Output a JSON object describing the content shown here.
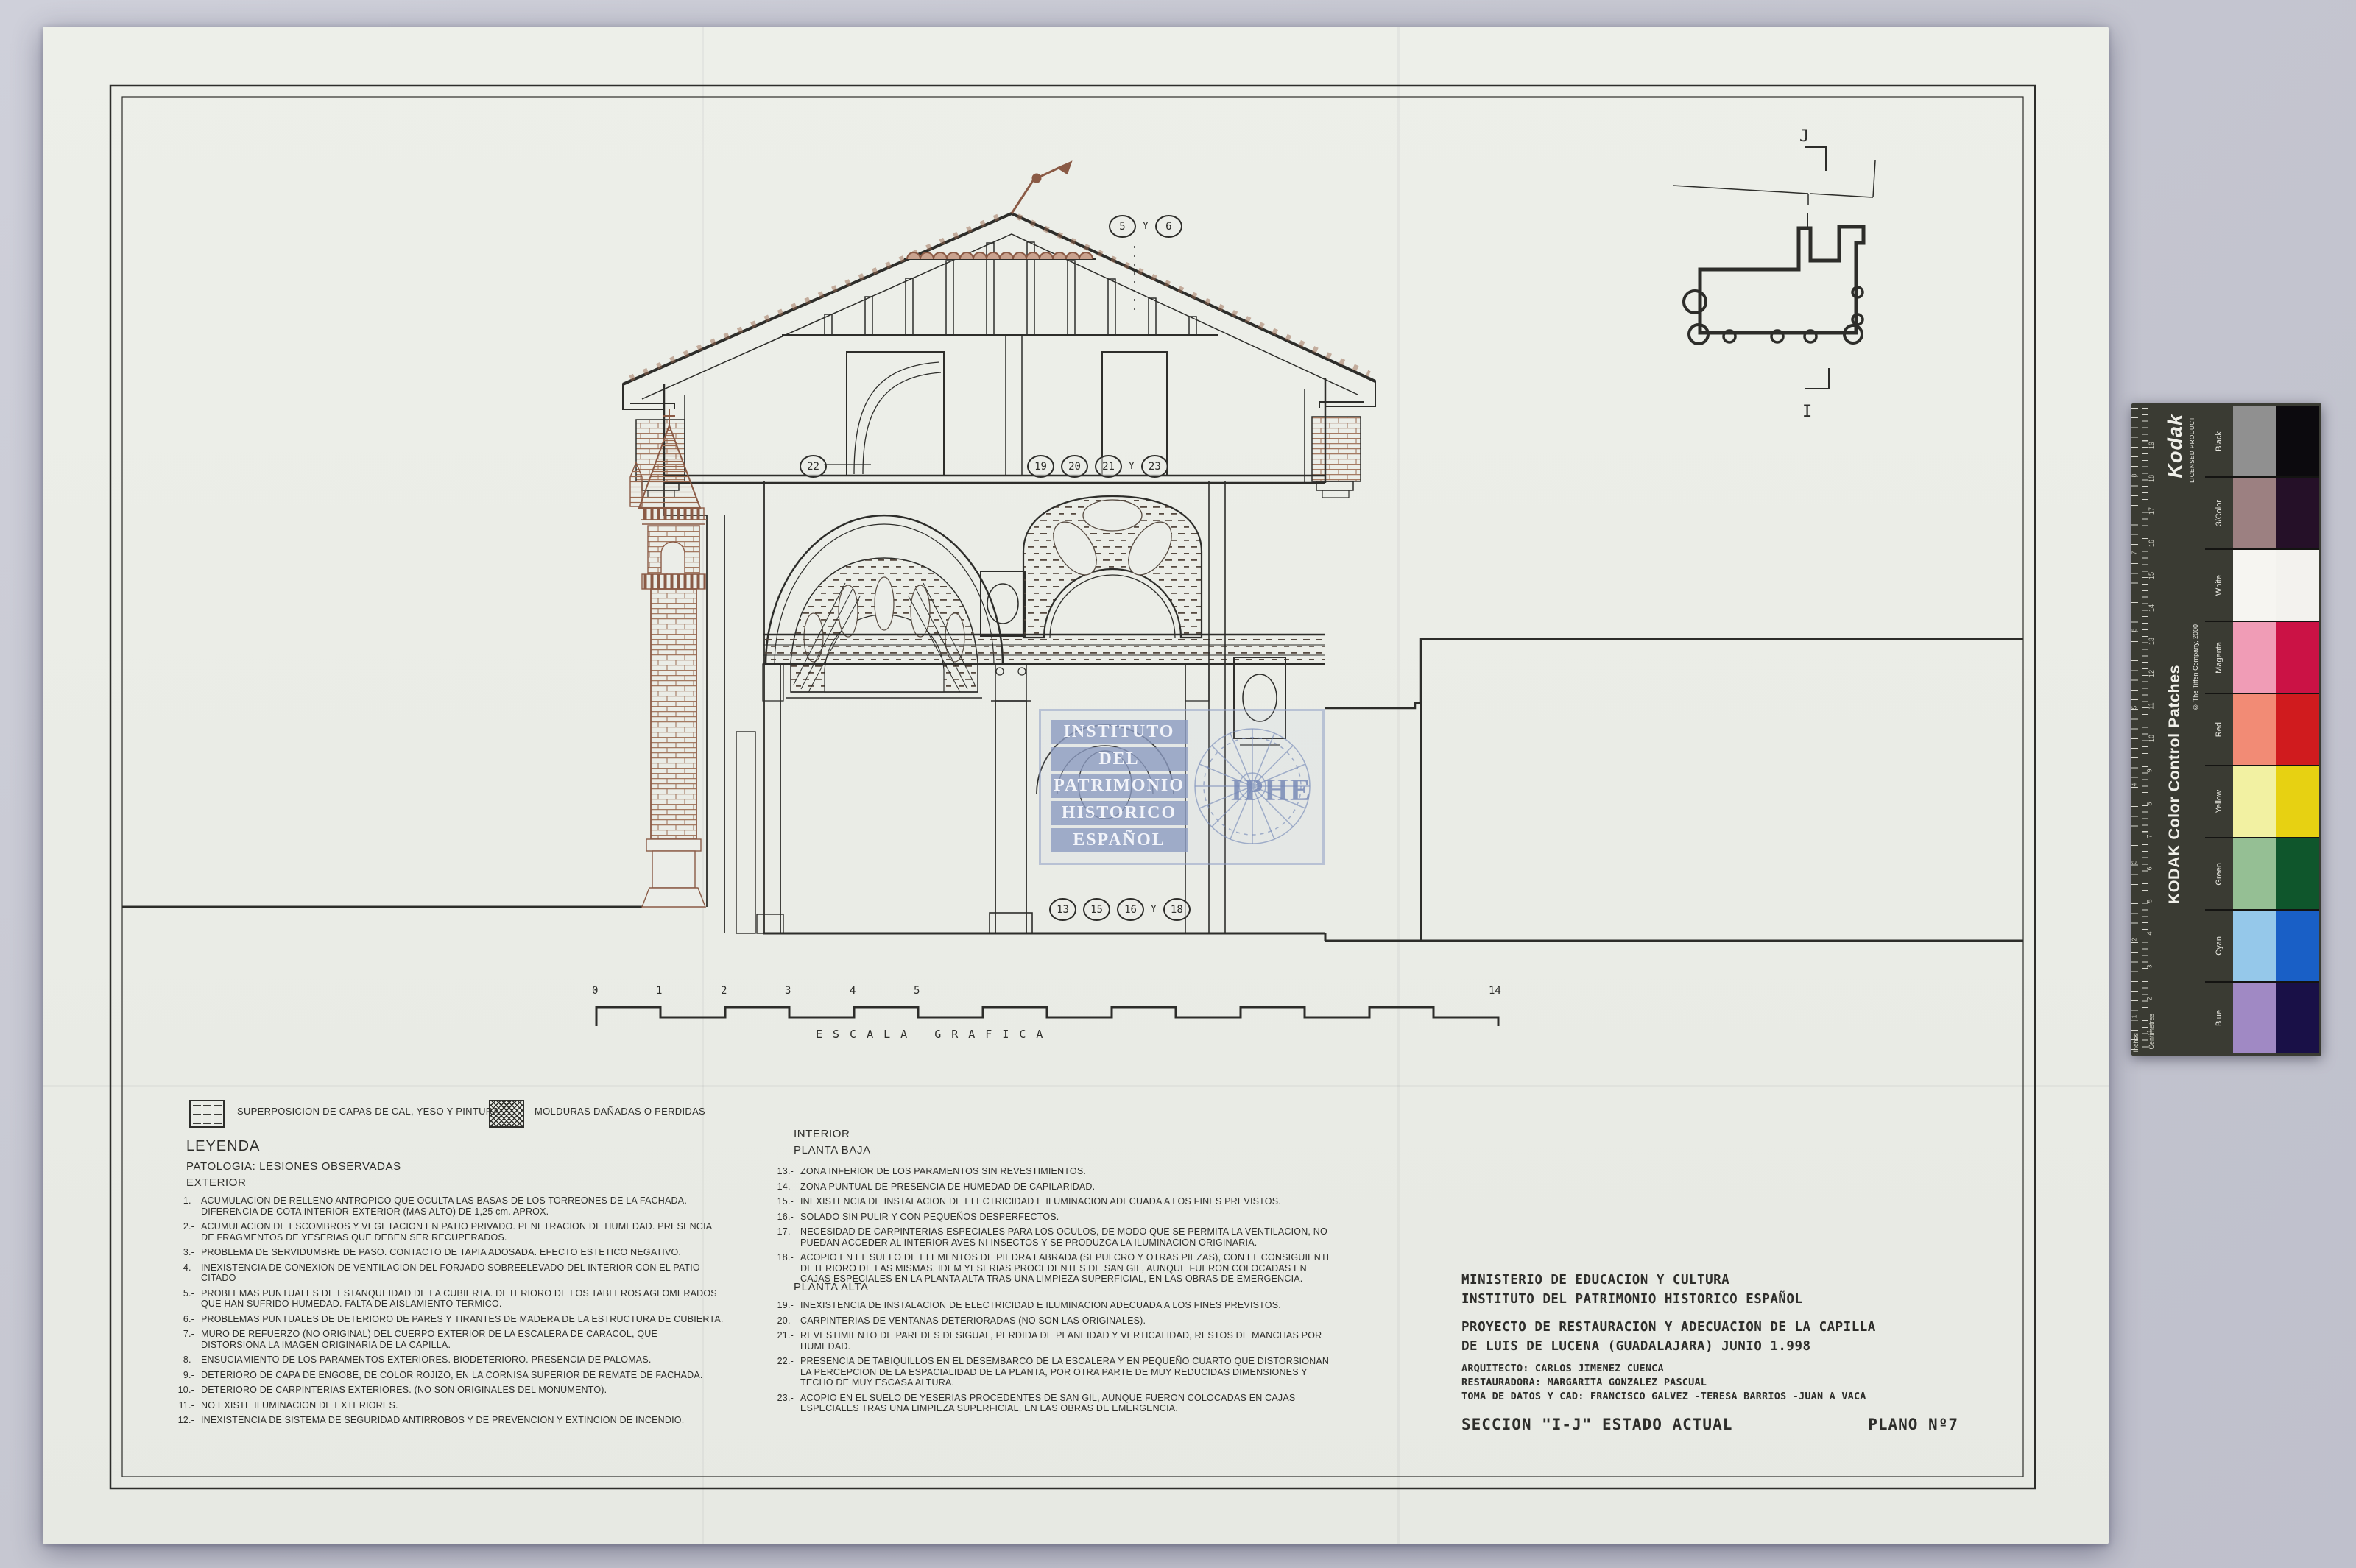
{
  "colors": {
    "board": "#c6c7d1",
    "paper": "#ebede8",
    "ink": "#2d2d2a",
    "sepia": "#8a5a45",
    "watermark_blue": "#8c9dc0"
  },
  "legend": {
    "swatches": [
      {
        "label": "SUPERPOSICION DE CAPAS DE CAL, YESO Y PINTURA"
      },
      {
        "label": "MOLDURAS DAÑADAS O PERDIDAS"
      }
    ],
    "title": "LEYENDA",
    "subtitle": "PATOLOGIA: LESIONES OBSERVADAS",
    "exterior_header": "EXTERIOR",
    "exterior": [
      {
        "num": "1.-",
        "text": "ACUMULACION DE RELLENO ANTROPICO QUE OCULTA LAS BASAS DE LOS TORREONES DE LA FACHADA. DIFERENCIA DE COTA INTERIOR-EXTERIOR (MAS ALTO) DE 1,25 cm. APROX."
      },
      {
        "num": "2.-",
        "text": "ACUMULACION DE ESCOMBROS Y VEGETACION EN PATIO PRIVADO. PENETRACION DE HUMEDAD. PRESENCIA DE FRAGMENTOS DE YESERIAS QUE DEBEN SER RECUPERADOS."
      },
      {
        "num": "3.-",
        "text": "PROBLEMA DE SERVIDUMBRE DE PASO. CONTACTO DE TAPIA ADOSADA. EFECTO ESTETICO NEGATIVO."
      },
      {
        "num": "4.-",
        "text": "INEXISTENCIA DE CONEXION DE VENTILACION DEL FORJADO SOBREELEVADO DEL INTERIOR CON EL PATIO CITADO"
      },
      {
        "num": "5.-",
        "text": "PROBLEMAS PUNTUALES DE ESTANQUEIDAD DE LA CUBIERTA. DETERIORO DE LOS TABLEROS AGLOMERADOS QUE HAN SUFRIDO HUMEDAD. FALTA DE AISLAMIENTO TERMICO."
      },
      {
        "num": "6.-",
        "text": "PROBLEMAS PUNTUALES DE DETERIORO DE PARES Y TIRANTES DE MADERA DE LA ESTRUCTURA DE CUBIERTA."
      },
      {
        "num": "7.-",
        "text": "MURO DE REFUERZO (NO ORIGINAL) DEL CUERPO EXTERIOR DE LA ESCALERA DE CARACOL, QUE DISTORSIONA LA IMAGEN ORIGINARIA DE LA CAPILLA."
      },
      {
        "num": "8.-",
        "text": "ENSUCIAMIENTO DE LOS PARAMENTOS EXTERIORES. BIODETERIORO. PRESENCIA DE PALOMAS."
      },
      {
        "num": "9.-",
        "text": "DETERIORO DE CAPA DE ENGOBE, DE COLOR ROJIZO, EN LA CORNISA SUPERIOR DE REMATE DE FACHADA."
      },
      {
        "num": "10.-",
        "text": "DETERIORO DE CARPINTERIAS EXTERIORES. (NO SON ORIGINALES DEL MONUMENTO)."
      },
      {
        "num": "11.-",
        "text": "NO EXISTE ILUMINACION DE EXTERIORES."
      },
      {
        "num": "12.-",
        "text": "INEXISTENCIA DE SISTEMA DE SEGURIDAD ANTIRROBOS Y DE PREVENCION Y EXTINCION DE INCENDIO."
      }
    ],
    "interior_header": "INTERIOR",
    "planta_baja_header": "PLANTA BAJA",
    "planta_baja": [
      {
        "num": "13.-",
        "text": "ZONA INFERIOR DE LOS PARAMENTOS SIN REVESTIMIENTOS."
      },
      {
        "num": "14.-",
        "text": "ZONA PUNTUAL DE PRESENCIA DE HUMEDAD DE CAPILARIDAD."
      },
      {
        "num": "15.-",
        "text": "INEXISTENCIA DE INSTALACION DE ELECTRICIDAD E ILUMINACION ADECUADA A LOS FINES PREVISTOS."
      },
      {
        "num": "16.-",
        "text": "SOLADO SIN PULIR Y CON PEQUEÑOS DESPERFECTOS."
      },
      {
        "num": "17.-",
        "text": "NECESIDAD DE CARPINTERIAS ESPECIALES PARA LOS OCULOS, DE MODO QUE SE PERMITA LA VENTILACION, NO PUEDAN ACCEDER AL INTERIOR AVES NI INSECTOS Y SE PRODUZCA LA ILUMINACION ORIGINARIA."
      },
      {
        "num": "18.-",
        "text": "ACOPIO EN EL SUELO DE ELEMENTOS DE PIEDRA LABRADA (SEPULCRO Y OTRAS PIEZAS), CON EL CONSIGUIENTE DETERIORO DE LAS MISMAS. IDEM YESERIAS PROCEDENTES DE SAN GIL, AUNQUE FUERON COLOCADAS EN CAJAS ESPECIALES EN LA PLANTA ALTA TRAS UNA LIMPIEZA SUPERFICIAL, EN LAS OBRAS DE EMERGENCIA."
      }
    ],
    "planta_alta_header": "PLANTA ALTA",
    "planta_alta": [
      {
        "num": "19.-",
        "text": "INEXISTENCIA DE INSTALACION DE ELECTRICIDAD E ILUMINACION ADECUADA A LOS FINES PREVISTOS."
      },
      {
        "num": "20.-",
        "text": "CARPINTERIAS DE VENTANAS DETERIORADAS (NO SON LAS ORIGINALES)."
      },
      {
        "num": "21.-",
        "text": "REVESTIMIENTO DE PAREDES DESIGUAL, PERDIDA DE PLANEIDAD Y VERTICALIDAD, RESTOS DE MANCHAS POR HUMEDAD."
      },
      {
        "num": "22.-",
        "text": "PRESENCIA DE TABIQUILLOS EN EL DESEMBARCO DE LA ESCALERA Y EN PEQUEÑO CUARTO QUE DISTORSIONAN LA PERCEPCION DE LA ESPACIALIDAD DE LA PLANTA, POR OTRA PARTE DE MUY REDUCIDAS DIMENSIONES Y TECHO DE MUY ESCASA ALTURA."
      },
      {
        "num": "23.-",
        "text": "ACOPIO EN EL SUELO DE YESERIAS PROCEDENTES DE SAN GIL, AUNQUE FUERON COLOCADAS EN CAJAS ESPECIALES TRAS UNA LIMPIEZA SUPERFICIAL, EN LAS OBRAS DE EMERGENCIA."
      }
    ]
  },
  "annotations": {
    "roof": [
      "5",
      "6"
    ],
    "upper_left": "22",
    "upper_right": [
      "19",
      "20",
      "21",
      "23"
    ],
    "lower": [
      "13",
      "15",
      "16",
      "18"
    ],
    "separator": "Y"
  },
  "scale_bar": {
    "ticks": [
      "0",
      "1",
      "2",
      "3",
      "4",
      "5",
      "14"
    ],
    "caption": "ESCALA GRAFICA"
  },
  "watermark": {
    "lines": [
      "INSTITUTO",
      "DEL",
      "PATRIMONIO",
      "HISTORICO",
      "ESPAÑOL"
    ],
    "acronym": "IPHE"
  },
  "site_plan": {
    "top_label": "J",
    "bottom_label": "I"
  },
  "title_block": {
    "ministry": "MINISTERIO DE EDUCACION Y CULTURA",
    "institute": "INSTITUTO DEL PATRIMONIO HISTORICO ESPAÑOL",
    "project_line1": "PROYECTO DE RESTAURACION Y ADECUACION DE LA CAPILLA",
    "project_line2": "DE LUIS DE LUCENA (GUADALAJARA) JUNIO 1.998",
    "architect": "ARQUITECTO: CARLOS JIMENEZ CUENCA",
    "restorer": "RESTAURADORA: MARGARITA GONZALEZ PASCUAL",
    "cad": "TOMA DE DATOS Y CAD: FRANCISCO GALVEZ -TERESA BARRIOS -JUAN A VACA",
    "section": "SECCION \"I-J\" ESTADO ACTUAL",
    "plan_number": "PLANO Nº7"
  },
  "kodak": {
    "brand": "Kodak",
    "licensed": "LICENSED PRODUCT",
    "title": "KODAK Color Control Patches",
    "copyright": "© The Tiffen Company, 2000",
    "ruler_labels": {
      "cm": "Centimetres",
      "inch": "Inches"
    },
    "cm_numbers": [
      "1",
      "2",
      "3",
      "4",
      "5",
      "6",
      "7",
      "8",
      "9",
      "10",
      "11",
      "12",
      "13",
      "14",
      "15",
      "16",
      "17",
      "18",
      "19"
    ],
    "inch_numbers": [
      "1",
      "2",
      "3",
      "4",
      "5",
      "6",
      "7",
      "8"
    ],
    "rows": [
      {
        "label": "Black",
        "light": "#909090",
        "dark": "#0c0a0e"
      },
      {
        "label": "3/Color",
        "light": "#9c8081",
        "dark": "#251028"
      },
      {
        "label": "White",
        "light": "#f6f5f1",
        "dark": "#f3f2ee"
      },
      {
        "label": "Magenta",
        "light": "#f09cb6",
        "dark": "#cb1245"
      },
      {
        "label": "Red",
        "light": "#f28b75",
        "dark": "#d01b1e"
      },
      {
        "label": "Yellow",
        "light": "#f2f1a2",
        "dark": "#e7d112"
      },
      {
        "label": "Green",
        "light": "#95bf94",
        "dark": "#0f562c"
      },
      {
        "label": "Cyan",
        "light": "#95c8ea",
        "dark": "#195fc6"
      },
      {
        "label": "Blue",
        "light": "#a089c4",
        "dark": "#191047"
      }
    ]
  }
}
